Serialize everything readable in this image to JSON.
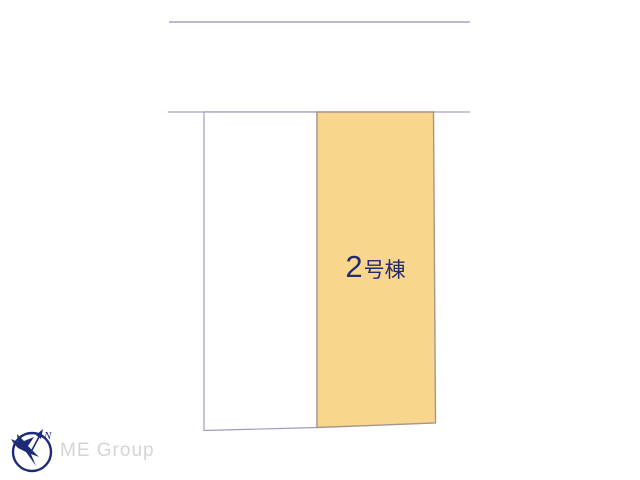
{
  "page": {
    "background_color": "#ffffff",
    "type": "real-estate-lot-layout-diagram"
  },
  "plan": {
    "line_color": "#a3a3c4",
    "boundary_lines": [
      {
        "name": "upper-boundary",
        "x1": "169",
        "y1": "22",
        "x2": "470",
        "y2": "22"
      },
      {
        "name": "lower-boundary",
        "x1": "168",
        "y1": "112",
        "x2": "470",
        "y2": "112"
      }
    ],
    "plots": [
      {
        "name": "adjacent-lot",
        "points": "204,112 317,112 317,427.5 204,430.5",
        "fill": "#ffffff",
        "stroke": "#9c9cc2",
        "label": ""
      },
      {
        "name": "lot-building-2",
        "points": "317,112 433.5,112 435.5,423 317,427.5",
        "fill": "#f8d68d",
        "stroke": "#a5968b",
        "label": "2号棟"
      }
    ]
  },
  "building_label": {
    "number": "2",
    "suffix": "号棟",
    "color": "#242b6e"
  },
  "logo": {
    "company_name": "ME Group",
    "north_label": "N",
    "mark_color": "#1d2a78",
    "text_color": "#d4d4d4"
  }
}
